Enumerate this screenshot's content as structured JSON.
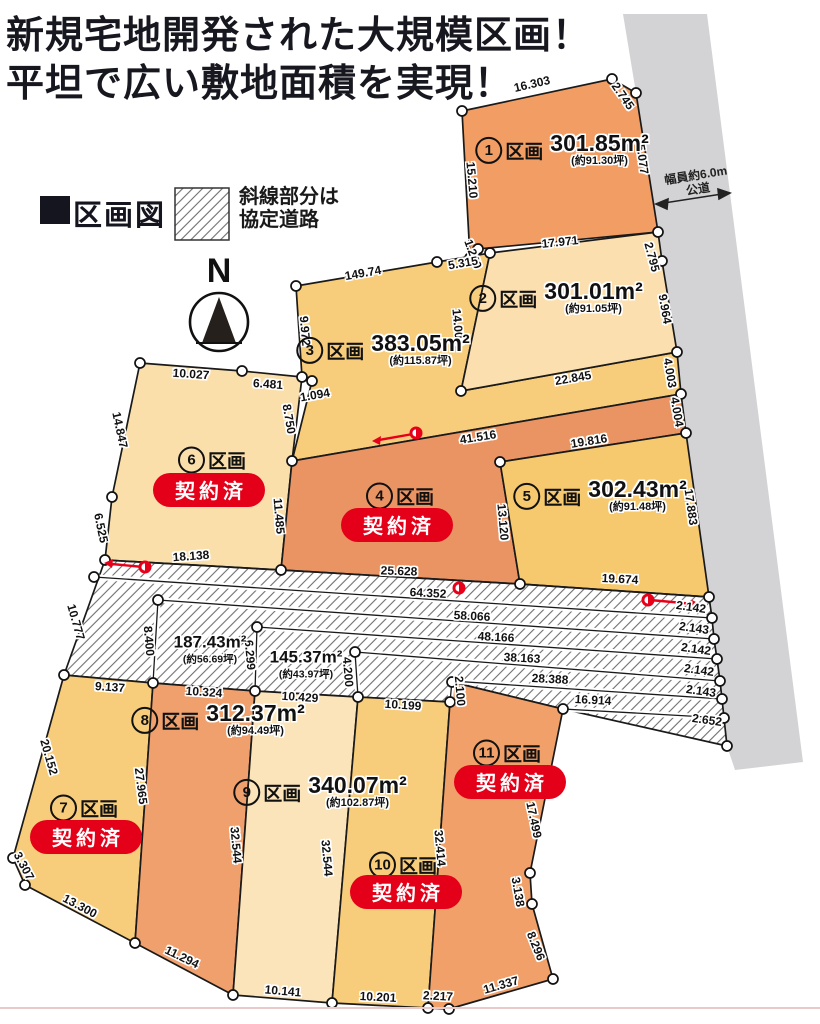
{
  "title": {
    "line1": "新規宅地開発された大規模区画！",
    "line2": "平坦で広い敷地面積を実現！"
  },
  "legend": {
    "map_title": "区画図",
    "hatch_label_line1": "斜線部分は",
    "hatch_label_line2": "協定道路"
  },
  "compass": {
    "north_label": "N"
  },
  "public_road": {
    "line1": "幅員約6.0m",
    "line2": "公道"
  },
  "plots": [
    {
      "no": "1",
      "suffix": "区画",
      "area": "301.85m²",
      "tsubo": "(約91.30坪)",
      "status": null
    },
    {
      "no": "2",
      "suffix": "区画",
      "area": "301.01m²",
      "tsubo": "(約91.05坪)",
      "status": null
    },
    {
      "no": "3",
      "suffix": "区画",
      "area": "383.05m²",
      "tsubo": "(約115.87坪)",
      "status": null
    },
    {
      "no": "4",
      "suffix": "区画",
      "area": null,
      "tsubo": null,
      "status": "契約済"
    },
    {
      "no": "5",
      "suffix": "区画",
      "area": "302.43m²",
      "tsubo": "(約91.48坪)",
      "status": null
    },
    {
      "no": "6",
      "suffix": "区画",
      "area": null,
      "tsubo": null,
      "status": "契約済"
    },
    {
      "no": "7",
      "suffix": "区画",
      "area": null,
      "tsubo": null,
      "status": "契約済"
    },
    {
      "no": "8",
      "suffix": "区画",
      "area": "312.37m²",
      "tsubo": "(約94.49坪)",
      "status": null
    },
    {
      "no": "9",
      "suffix": "区画",
      "area": "340.07m²",
      "tsubo": "(約102.87坪)",
      "status": null
    },
    {
      "no": "10",
      "suffix": "区画",
      "area": null,
      "tsubo": null,
      "status": "契約済"
    },
    {
      "no": "11",
      "suffix": "区画",
      "area": null,
      "tsubo": null,
      "status": "契約済"
    }
  ],
  "agreement_road_areas": [
    {
      "area": "187.43m²",
      "tsubo": "(約56.69坪)"
    },
    {
      "area": "145.37m²",
      "tsubo": "(約43.97坪)"
    }
  ],
  "dimensions": [
    "16.303",
    "2.745",
    "15.077",
    "15.210",
    "17.971",
    "1.249",
    "2.795",
    "5.315",
    "9.964",
    "14.000",
    "22.845",
    "4.003",
    "149.74",
    "9.972",
    "1.094",
    "8.750",
    "10.027",
    "6.481",
    "14.847",
    "6.525",
    "11.485",
    "18.138",
    "41.516",
    "25.628",
    "19.816",
    "17.883",
    "13.120",
    "19.674",
    "4.004",
    "10.777",
    "64.352",
    "58.066",
    "48.166",
    "38.163",
    "28.388",
    "16.914",
    "8.400",
    "6.299",
    "4.200",
    "2.100",
    "2.142",
    "2.143",
    "2.142",
    "2.142",
    "2.143",
    "2.652",
    "9.137",
    "20.152",
    "27.965",
    "3.307",
    "13.300",
    "10.324",
    "32.544",
    "11.294",
    "10.429",
    "32.544",
    "10.141",
    "10.199",
    "32.414",
    "10.201",
    "2.217",
    "17.499",
    "3.138",
    "8.296",
    "11.337"
  ],
  "colors": {
    "plot1": "#f19d63",
    "plot2": "#fbdfae",
    "plot3": "#f7cc7a",
    "plot4": "#ea9463",
    "plot5": "#f6c96f",
    "plot6": "#fadfab",
    "plot7": "#f7cc7a",
    "plot8": "#efa06d",
    "plot9": "#fbe4ba",
    "plot10": "#f7cc7a",
    "plot11": "#f0a068",
    "public_road_gray": "#d3d3d5",
    "badge_red": "#e50019",
    "marker_red": "#e60019",
    "line_black": "#1a1a1a"
  }
}
